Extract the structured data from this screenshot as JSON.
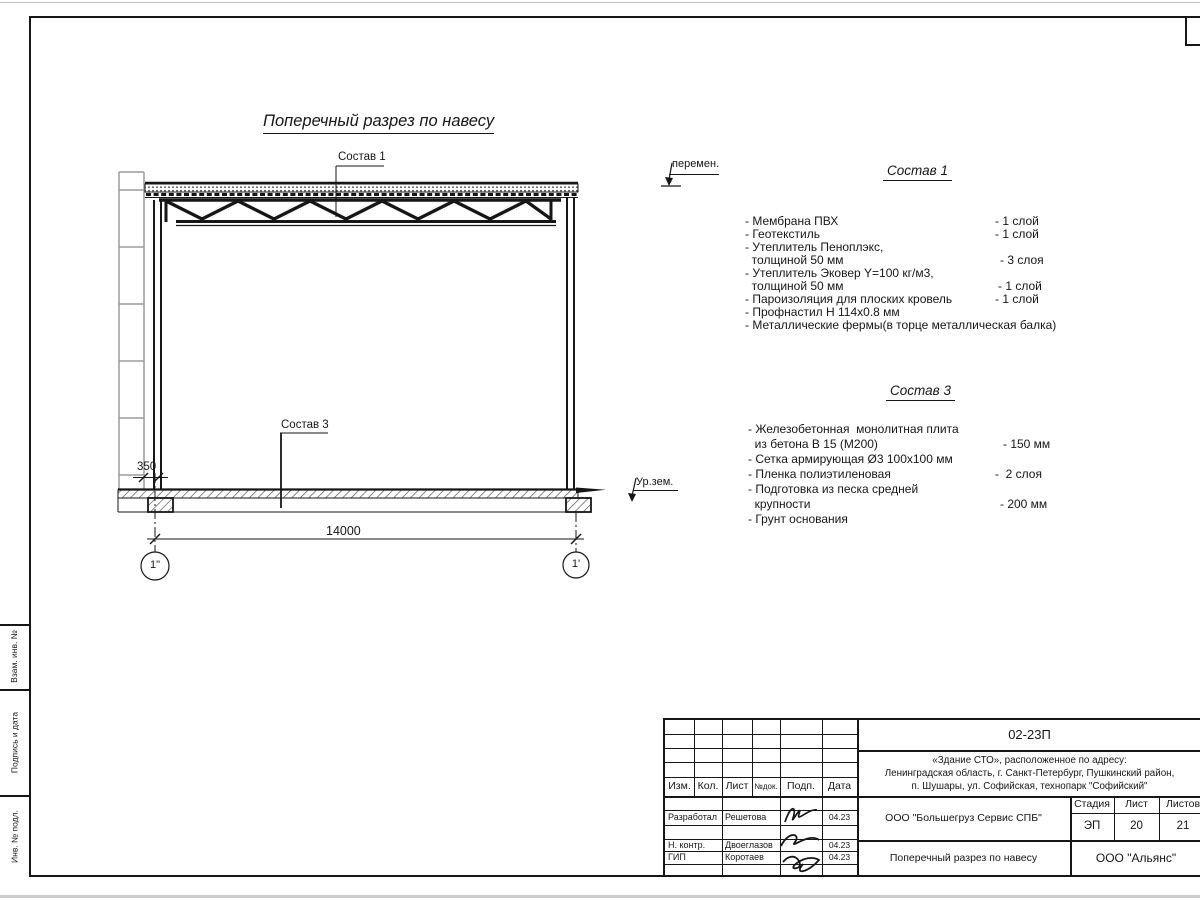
{
  "sheet": {
    "drawing_title_main": "Поперечный разрез по навесу",
    "callouts": {
      "sostav1": "Состав 1",
      "sostav3": "Состав 3",
      "peremen": "перемен.",
      "ur_zem": "Ур.зем."
    },
    "dims": {
      "d350": "350",
      "d14000": "14000"
    },
    "axes": {
      "left": "1\"",
      "right": "1'"
    }
  },
  "sostav1": {
    "heading": "Состав 1",
    "lines": [
      {
        "l": "- Мембрана ПВХ",
        "r": "- 1 слой"
      },
      {
        "l": "- Геотекстиль",
        "r": "- 1 слой"
      },
      {
        "l": "- Утеплитель Пеноплэкс,",
        "r": ""
      },
      {
        "l": "  толщиной 50 мм",
        "r": "- 3 слоя"
      },
      {
        "l": "- Утеплитель Эковер Y=100 кг/м3,",
        "r": ""
      },
      {
        "l": "  толщиной 50 мм",
        "r": "- 1 слой"
      },
      {
        "l": "- Пароизоляция для плоских кровель",
        "r": "- 1 слой"
      },
      {
        "l": "- Профнастил Н 114х0.8 мм",
        "r": ""
      },
      {
        "l": "- Металлические фермы(в торце металлическая балка)",
        "r": ""
      }
    ]
  },
  "sostav3": {
    "heading": "Состав 3",
    "lines": [
      {
        "l": "- Железобетонная  монолитная плита",
        "r": ""
      },
      {
        "l": "  из бетона В 15 (М200)",
        "r": "- 150 мм"
      },
      {
        "l": "- Сетка армирующая Ø3 100х100 мм",
        "r": ""
      },
      {
        "l": "- Пленка полиэтиленовая",
        "r": "-  2 слоя"
      },
      {
        "l": "- Подготовка из песка средней",
        "r": ""
      },
      {
        "l": "  крупности",
        "r": "- 200 мм"
      },
      {
        "l": "- Грунт основания",
        "r": ""
      }
    ]
  },
  "stamp_strip": {
    "cells": [
      "Взам. инв. №",
      "Подпись и дата",
      "Инв. № подл."
    ]
  },
  "titleblock": {
    "doc_number": "02-23П",
    "project": [
      "«Здание СТО», расположенное по адресу:",
      "Ленинградская область, г. Санкт-Петербург, Пушкинский район,",
      "п. Шушары, ул. Софийская, технопарк \"Софийский\""
    ],
    "columns": [
      "Изм.",
      "Кол.",
      "Лист",
      "№док.",
      "Подп.",
      "Дата"
    ],
    "rows": [
      {
        "role": "Разработал",
        "name": "Решетова",
        "date": "04.23"
      },
      {
        "role": "Н. контр.",
        "name": "Двоеглазов",
        "date": "04.23"
      },
      {
        "role": "ГИП",
        "name": "Коротаев",
        "date": "04.23"
      }
    ],
    "company": "ООО \"Большегруз Сервис СПБ\"",
    "drawing_title": "Поперечный разрез по навесу",
    "org": "ООО \"Альянс\"",
    "stage_label": "Стадия",
    "sheet_label": "Лист",
    "sheets_label": "Листов",
    "stage": "ЭП",
    "sheet": "20",
    "sheets": "21"
  }
}
